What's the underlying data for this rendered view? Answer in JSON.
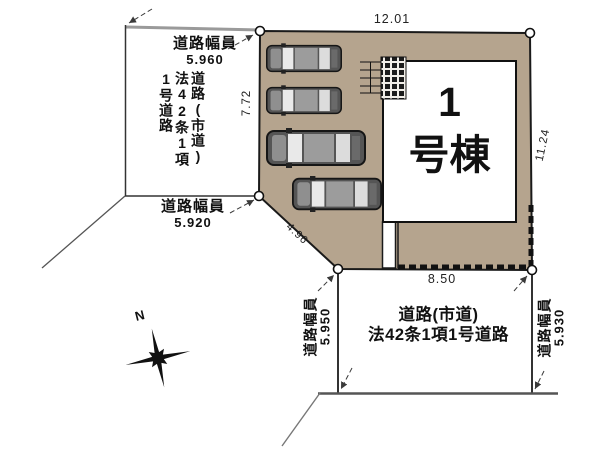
{
  "plan_type": "site-plan",
  "colors": {
    "lot_fill": "#b5a48e",
    "building_fill": "#ffffff",
    "outline": "#1a1a1a",
    "road_line": "#555555",
    "road_edge_gray": "#9a9a9a",
    "car_body": "#555555",
    "text": "#111111"
  },
  "lot": {
    "building": {
      "name_line1": "1",
      "name_line2": "号棟"
    },
    "dimensions": {
      "north": "12.01",
      "west": "7.72",
      "east": "11.24",
      "south": "8.50",
      "diagonal": "4.96"
    },
    "car_count": 4
  },
  "roads": {
    "west": {
      "name_vertical": "道路(市道)\n法42条1項\n1号道路",
      "width_top": {
        "label": "道路幅員",
        "value": "5.960"
      },
      "width_bottom": {
        "label": "道路幅員",
        "value": "5.920"
      }
    },
    "south": {
      "name_line1": "道路(市道)",
      "name_line2": "法42条1項1号道路",
      "width_west": {
        "label": "道路幅員",
        "value": "5.950"
      },
      "width_east": {
        "label": "道路幅員",
        "value": "5.930"
      }
    }
  },
  "compass": {
    "north": "N"
  }
}
